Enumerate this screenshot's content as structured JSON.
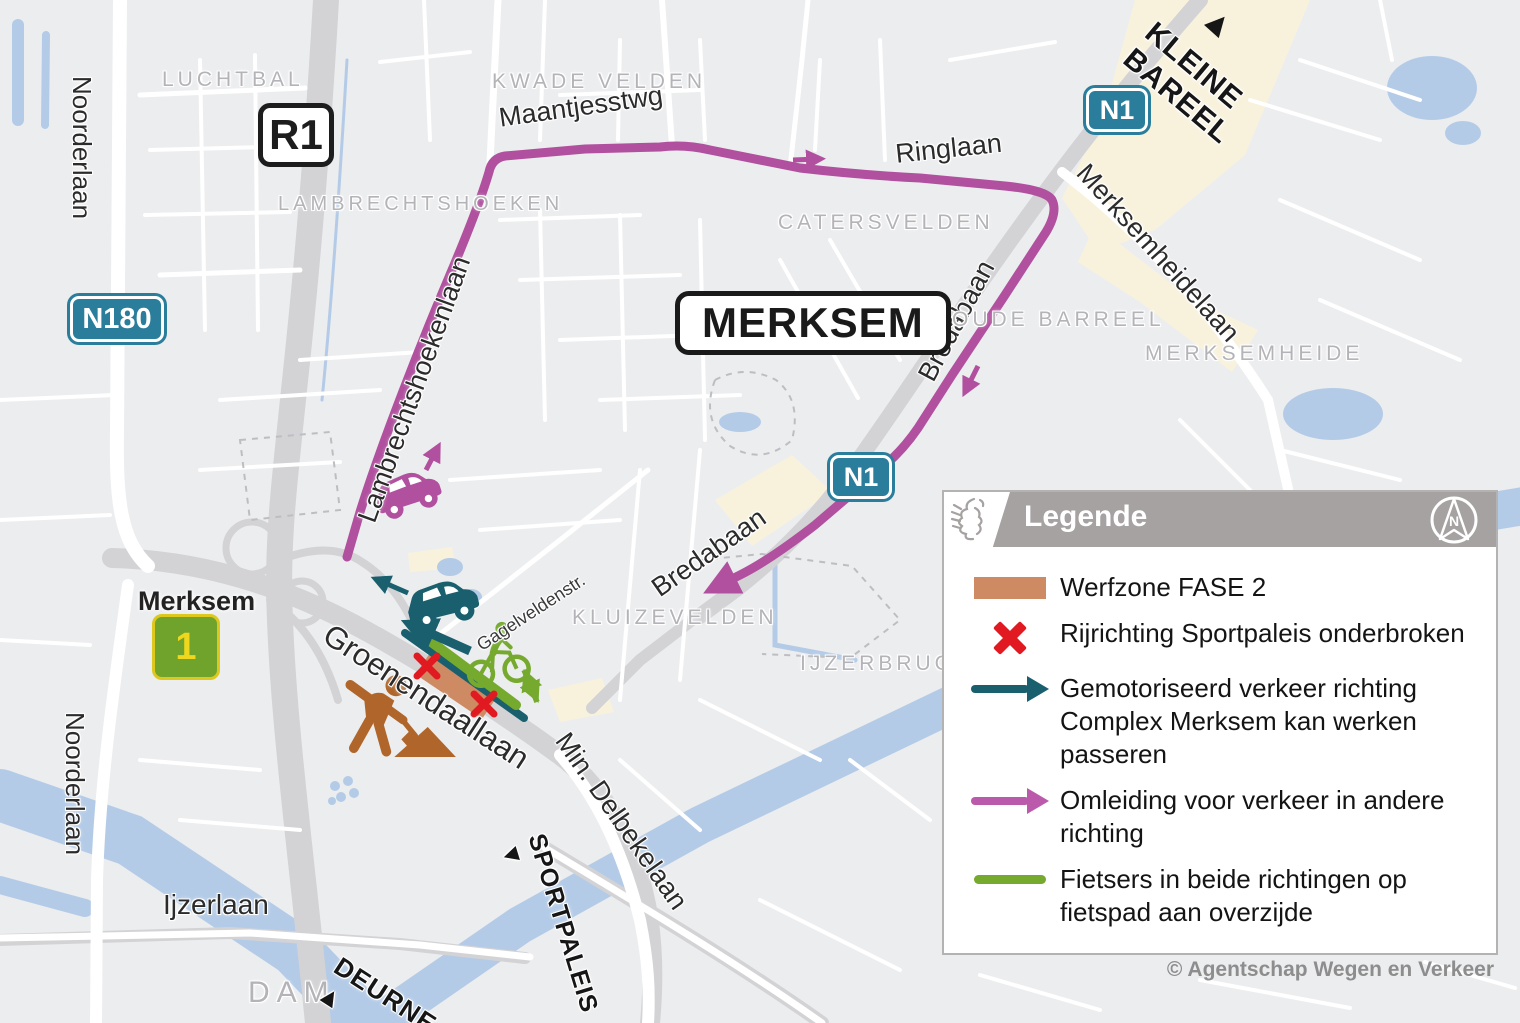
{
  "map": {
    "city": "MERKSEM",
    "shields": {
      "r1": "R1",
      "n180": "N180",
      "n1": "N1"
    },
    "exit": {
      "name": "Merksem",
      "number": "1"
    },
    "areas": {
      "luchtbal": "LUCHTBAL",
      "kwade_velden": "KWADE VELDEN",
      "lambrechtshoeken": "LAMBRECHTSHOEKEN",
      "catersvelden": "CATERSVELDEN",
      "oude_barreel": "OUDE BARREEL",
      "merksemheide": "MERKSEMHEIDE",
      "kluizevelden": "KLUIZEVELDEN",
      "ijzerbrug": "IJZERBRUG",
      "dam": "DAM"
    },
    "streets": {
      "noorderlaan": "Noorderlaan",
      "maantjesstwg": "Maantjesstwg",
      "ringlaan": "Ringlaan",
      "merksemheidelaan": "Merksemheidelaan",
      "lambrechtshoekenlaan": "Lambrechtshoekenlaan",
      "bredabaan": "Bredabaan",
      "gagelveldenstr": "Gagelveldenstr.",
      "groenendaallaan": "Groenendaallaan",
      "min_delbekelaan": "Min. Delbekelaan",
      "ijzerlaan": "Ijzerlaan"
    },
    "directions": {
      "kleine_bareel": "KLEINE\nBAREEL",
      "deurne": "DEURNE",
      "sportpaleis": "SPORTPALEIS",
      "arrow_up": "▲",
      "arrow_down": "▼"
    }
  },
  "legend": {
    "title": "Legende",
    "compass_letter": "N",
    "items": [
      {
        "label": "Werfzone FASE 2"
      },
      {
        "label": "Rijrichting Sportpaleis onderbroken"
      },
      {
        "label": "Gemotoriseerd verkeer richting Complex Merksem kan werken passeren"
      },
      {
        "label": "Omleiding voor verkeer in andere richting"
      },
      {
        "label": "Fietsers in beide richtingen op fietspad aan overzijde"
      }
    ]
  },
  "credit": "© Agentschap Wegen en Verkeer",
  "colors": {
    "detour": "#b0509e",
    "motorized": "#1a5f6e",
    "bicycle": "#75aa2f",
    "workzone": "#cd8a63",
    "closed": "#e11a22",
    "shield": "#2b7e9b"
  }
}
